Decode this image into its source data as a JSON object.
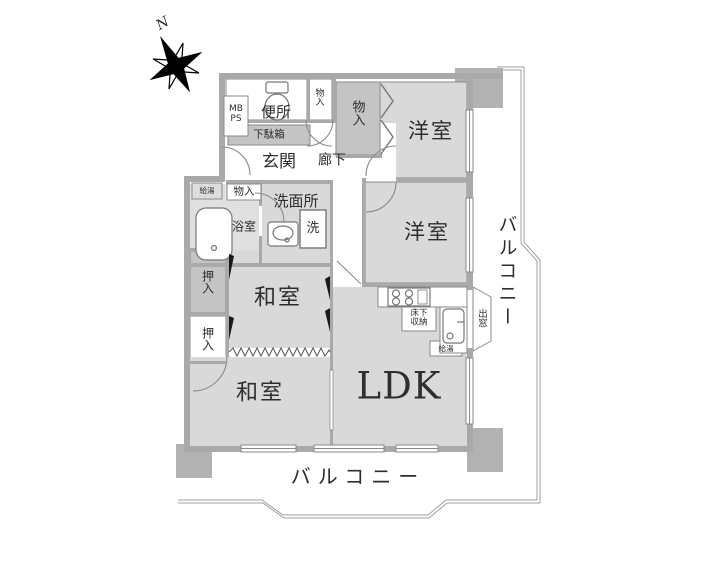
{
  "compass": {
    "north_label": "N"
  },
  "rooms": {
    "toilet": "便所",
    "entrance": "玄関",
    "hallway": "廊下",
    "western_room_1": "洋室",
    "western_room_2": "洋室",
    "washroom": "洗面所",
    "bathroom": "浴室",
    "japanese_room_1": "和室",
    "japanese_room_2": "和室",
    "ldk": "LDK"
  },
  "storage": {
    "closet_top": "物入",
    "closet_hall": "物入",
    "closet_wash": "物入",
    "oshiire_upper": "押入",
    "oshiire_lower": "押入",
    "shoe_cabinet": "下駄箱"
  },
  "fixtures": {
    "washing_machine": "洗",
    "underfloor_storage_line1": "床下",
    "underfloor_storage_line2": "収納",
    "water_heater_bath": "給湯",
    "water_heater_kitchen": "給湯",
    "meter_box_line1": "MB",
    "meter_box_line2": "PS",
    "bay_window": "出窓"
  },
  "balcony": {
    "right_label": "バルコニー",
    "bottom_label": "バルコニー"
  },
  "colors": {
    "wall": "#a9a9a9",
    "room_fill": "#d9d9d9",
    "storage_fill": "#c4c4c4",
    "bath_fill": "#e0e0e0",
    "line": "#8a8a8a",
    "pillar": "#b2b2b2"
  }
}
